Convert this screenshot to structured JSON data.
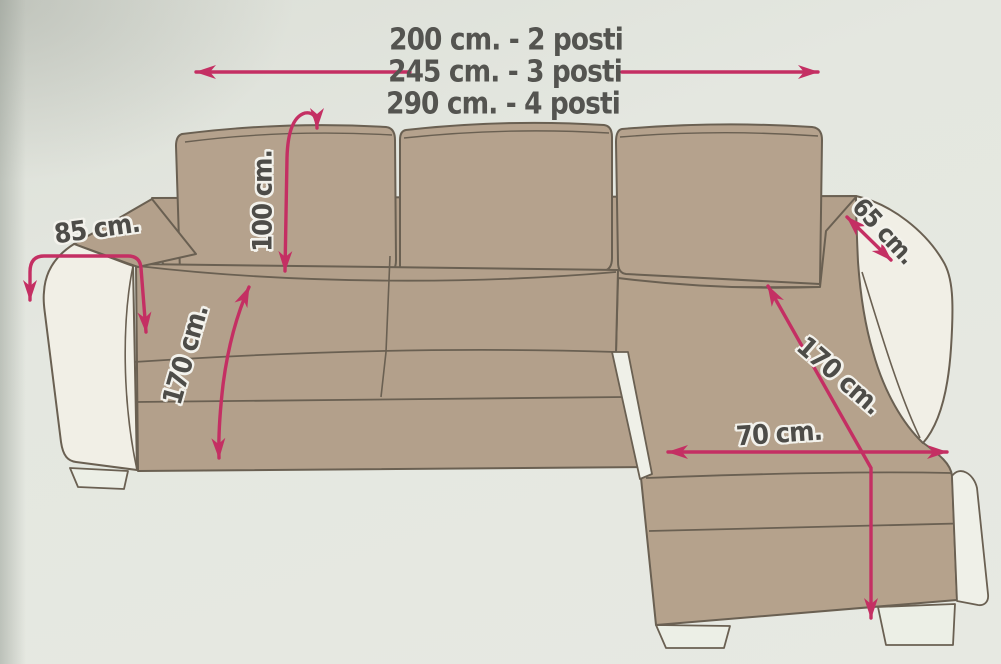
{
  "diagram": {
    "size_options": [
      "200 cm. - 2 posti",
      "245 cm. - 3 posti",
      "290 cm. - 4 posti"
    ],
    "measurements": {
      "armrest_width": "85 cm.",
      "backrest_height": "100 cm.",
      "depth_left": "170 cm.",
      "right_armrest_depth": "65 cm.",
      "chaise_length": "170 cm.",
      "chaise_width": "70 cm."
    },
    "colors": {
      "arrow": "#c42f63",
      "sofa_fabric": "#b3a08b",
      "sofa_trim_white": "#f1efe6",
      "outline": "#6a6052",
      "background": "#e4e7e0",
      "text": "#4d4c48"
    }
  }
}
